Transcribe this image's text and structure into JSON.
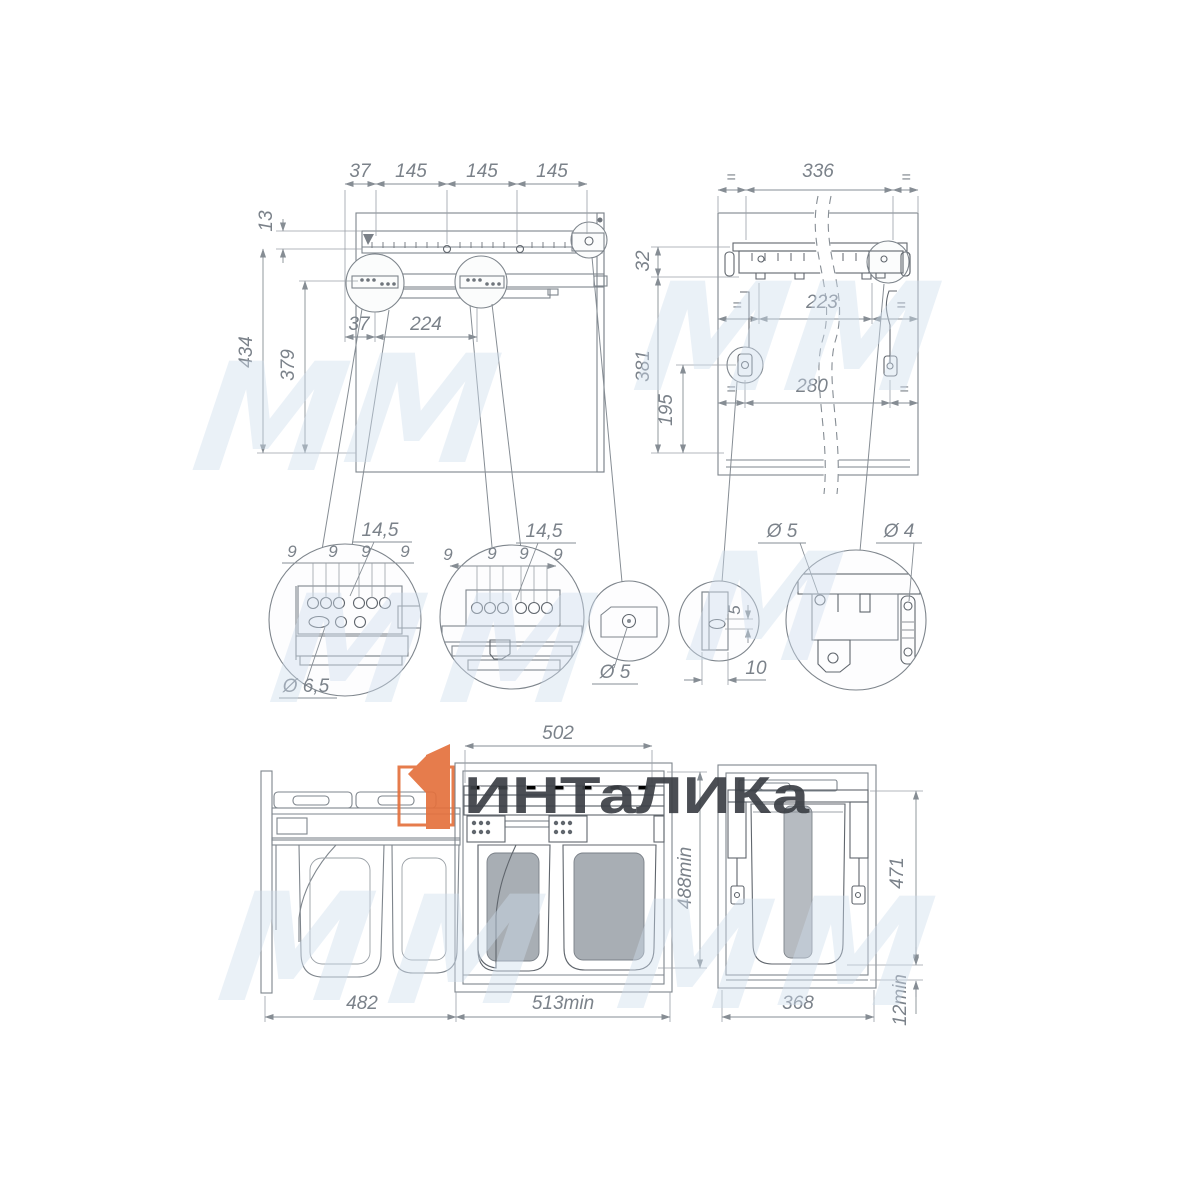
{
  "brand": {
    "name": "ИНТаЛИКа",
    "logo_color": "#e4713d",
    "text_color": "#3c4046"
  },
  "watermark": {
    "glyph": "М",
    "color": "#cfdeee"
  },
  "front_view": {
    "top_dims": [
      "37",
      "145",
      "145",
      "145"
    ],
    "offset_top": "13",
    "height_total": "434",
    "height_rail": "379",
    "inner_offset": "37",
    "inner_span": "224"
  },
  "back_view": {
    "eq": "=",
    "width_top": "336",
    "rail_height": "32",
    "height_total": "381",
    "height_bracket": "195",
    "span_hooks": "223",
    "span_feet": "280"
  },
  "details": {
    "circle_a": {
      "pitch": "14,5",
      "step": "9",
      "hole": "Ø 6,5"
    },
    "circle_b": {
      "pitch": "14,5",
      "step": "9"
    },
    "circle_c": {
      "hole": "Ø 5"
    },
    "circle_d": {
      "slot_height": "5",
      "slot_offset": "10"
    },
    "circle_e": {
      "hole_left": "Ø 5",
      "hole_right": "Ø 4"
    }
  },
  "bottom_views": {
    "unit_width": "502",
    "inner_height": "488min",
    "pullout_depth": "482",
    "cabinet_depth": "513min",
    "side_height": "471",
    "bottom_gap": "12min",
    "side_width": "368"
  }
}
